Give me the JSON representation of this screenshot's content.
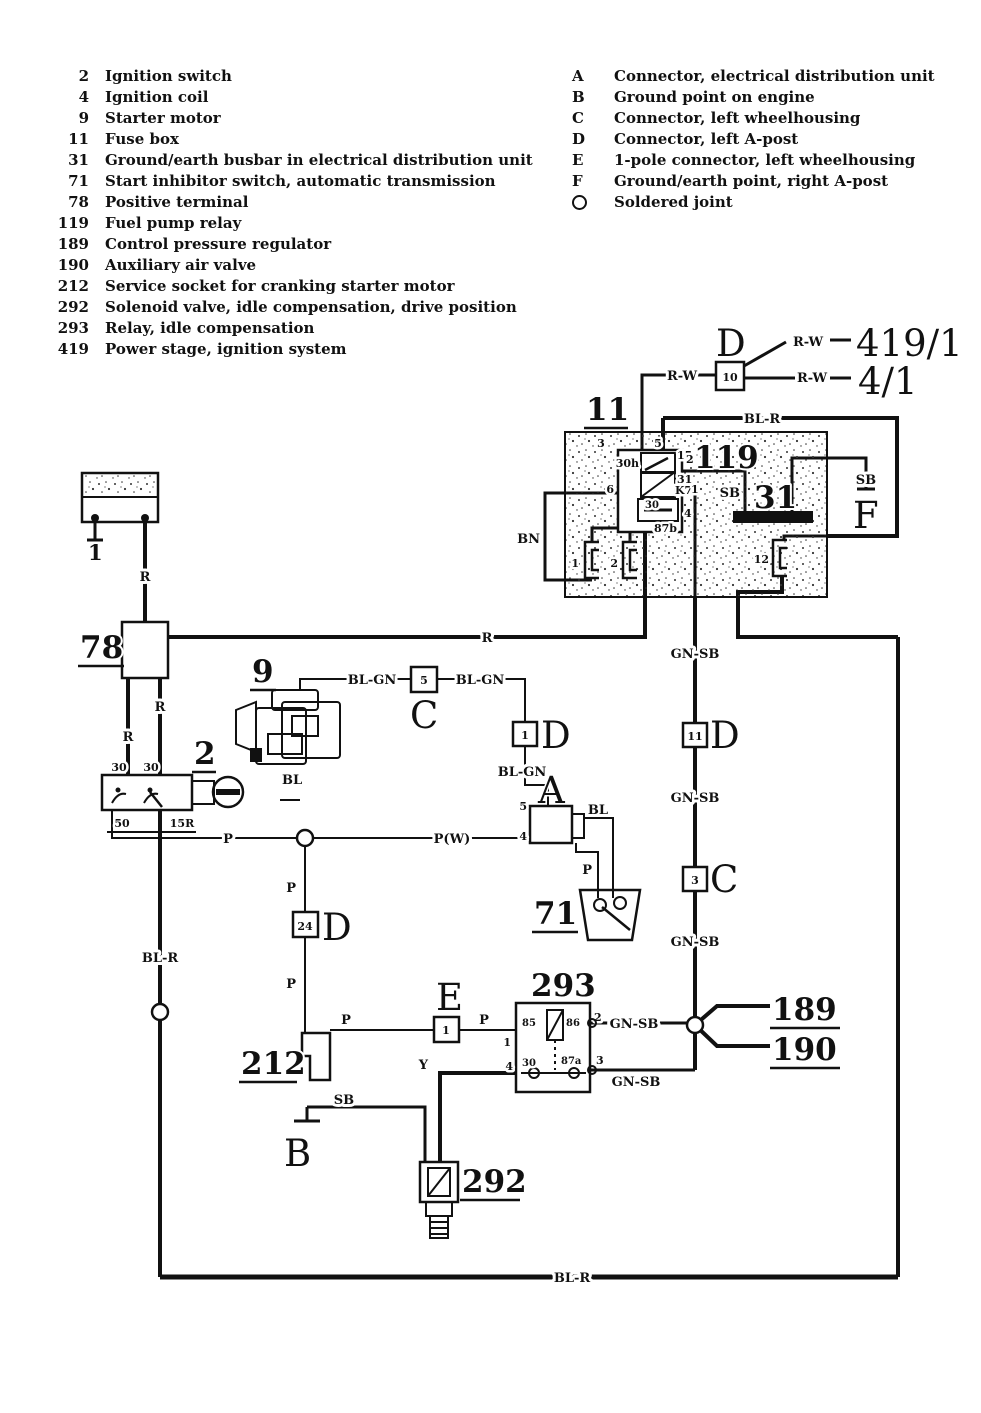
{
  "legend_left": {
    "items": [
      {
        "num": "2",
        "label": "Ignition switch"
      },
      {
        "num": "4",
        "label": "Ignition coil"
      },
      {
        "num": "9",
        "label": "Starter motor"
      },
      {
        "num": "11",
        "label": "Fuse box"
      },
      {
        "num": "31",
        "label": "Ground/earth busbar in electrical distribution unit"
      },
      {
        "num": "71",
        "label": "Start inhibitor switch, automatic transmission"
      },
      {
        "num": "78",
        "label": "Positive terminal"
      },
      {
        "num": "119",
        "label": "Fuel pump relay"
      },
      {
        "num": "189",
        "label": "Control pressure regulator"
      },
      {
        "num": "190",
        "label": "Auxiliary air valve"
      },
      {
        "num": "212",
        "label": "Service socket for cranking starter motor"
      },
      {
        "num": "292",
        "label": "Solenoid valve, idle compensation, drive position"
      },
      {
        "num": "293",
        "label": "Relay, idle compensation"
      },
      {
        "num": "419",
        "label": "Power stage, ignition system"
      }
    ]
  },
  "legend_right": {
    "items": [
      {
        "key": "A",
        "label": "Connector, electrical distribution unit"
      },
      {
        "key": "B",
        "label": "Ground point on engine"
      },
      {
        "key": "C",
        "label": "Connector, left wheelhousing"
      },
      {
        "key": "D",
        "label": "Connector, left A-post"
      },
      {
        "key": "E",
        "label": "1-pole connector, left wheelhousing"
      },
      {
        "key": "F",
        "label": "Ground/earth point, right A-post"
      },
      {
        "key": "",
        "label": "Soldered joint",
        "icon": "circle-icon"
      }
    ]
  },
  "components": {
    "battery": "1",
    "pos_terminal": "78",
    "ignition_switch": "2",
    "starter_motor": "9",
    "fuse_box": "11",
    "relay_fuel_pump": "119",
    "busbar": "31",
    "inhibitor_switch": "71",
    "service_socket": "212",
    "solenoid_valve": "292",
    "relay_idle": "293",
    "pressure_regulator": "189",
    "air_valve": "190",
    "power_stage": "419/1",
    "ignition_coil": "4/1"
  },
  "letters": {
    "A": "A",
    "B": "B",
    "C": "C",
    "D": "D",
    "E": "E",
    "F": "F"
  },
  "pins": {
    "d10": "10",
    "c5": "5",
    "d1": "1",
    "d24": "24",
    "d11": "11",
    "c3": "3",
    "e1": "1",
    "a_top": "5",
    "a_left": "4",
    "ign_30a": "30",
    "ign_30b": "30",
    "ign_50": "50",
    "ign_15r": "15R",
    "fuse1": "1",
    "fuse2": "2",
    "fuse12": "12",
    "r119_3": "3",
    "r119_5": "5",
    "r119_30h": "30h",
    "r119_15": "15",
    "r119_2": "2",
    "r119_31": "31",
    "r119_k7": "K7",
    "r119_1": "1",
    "r119_6": "6",
    "r119_30": "30",
    "r119_87b": "87b",
    "r119_4": "4",
    "r293_85": "85",
    "r293_86": "86",
    "r293_30": "30",
    "r293_87a": "87a",
    "r293_1": "1",
    "r293_2": "2",
    "r293_3": "3",
    "r293_4": "4"
  },
  "wires": {
    "r": "R",
    "rw": "R-W",
    "bl_r": "BL-R",
    "bl_gn": "BL-GN",
    "bl": "BL",
    "p": "P",
    "pw": "P(W)",
    "gn_sb": "GN-SB",
    "sb": "SB",
    "bn": "BN",
    "y": "Y"
  }
}
